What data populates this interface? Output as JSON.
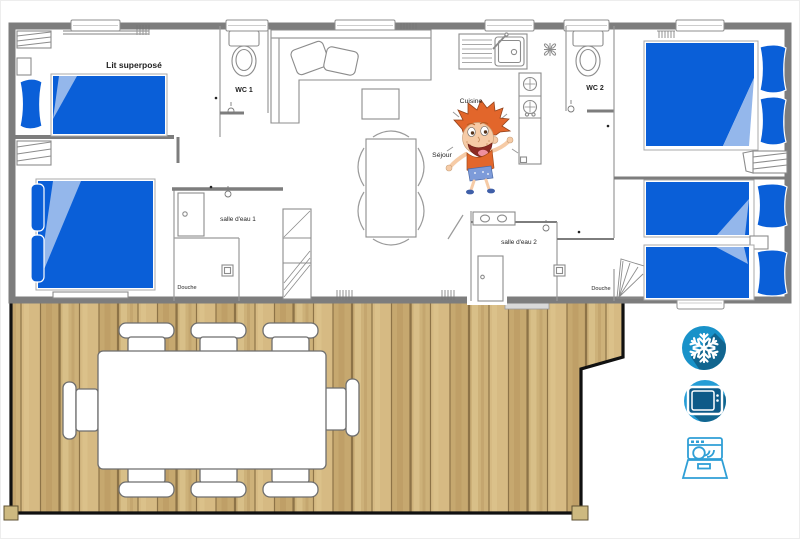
{
  "floorplan": {
    "title": "mobile-home floor plan",
    "rooms": {
      "bunk_bedroom": "Lit superposé",
      "wc1": "WC 1",
      "wc2": "WC 2",
      "kitchen": "Cuisine",
      "living": "Séjour",
      "bathroom1": "salle d'eau 1",
      "bathroom2": "salle d'eau 2",
      "shower1": "Douche",
      "shower2": "Douche"
    }
  },
  "amenities": [
    {
      "name": "air-conditioning",
      "icon": "snowflake-icon"
    },
    {
      "name": "television",
      "icon": "tv-icon"
    },
    {
      "name": "dishwasher",
      "icon": "dishwasher-icon"
    }
  ],
  "colors": {
    "bed_blue": "#0a5fd8",
    "bed_fold": "#94b7eb",
    "wall_gray": "#7d7d7d",
    "wood_base": "#cdb179",
    "wood_mid": "#d6ba83",
    "wood_deep": "#c6a86f",
    "wood_light": "#e4cd98",
    "plank_line": "#8d7347",
    "deck_border": "#111111",
    "snowflake_blue": "#1992c9",
    "tv_blue": "#259dd6",
    "icon_blue_dark": "#11658f",
    "icon_stroke": "#2f9fd6",
    "tv_screen": "#0e5a88"
  }
}
